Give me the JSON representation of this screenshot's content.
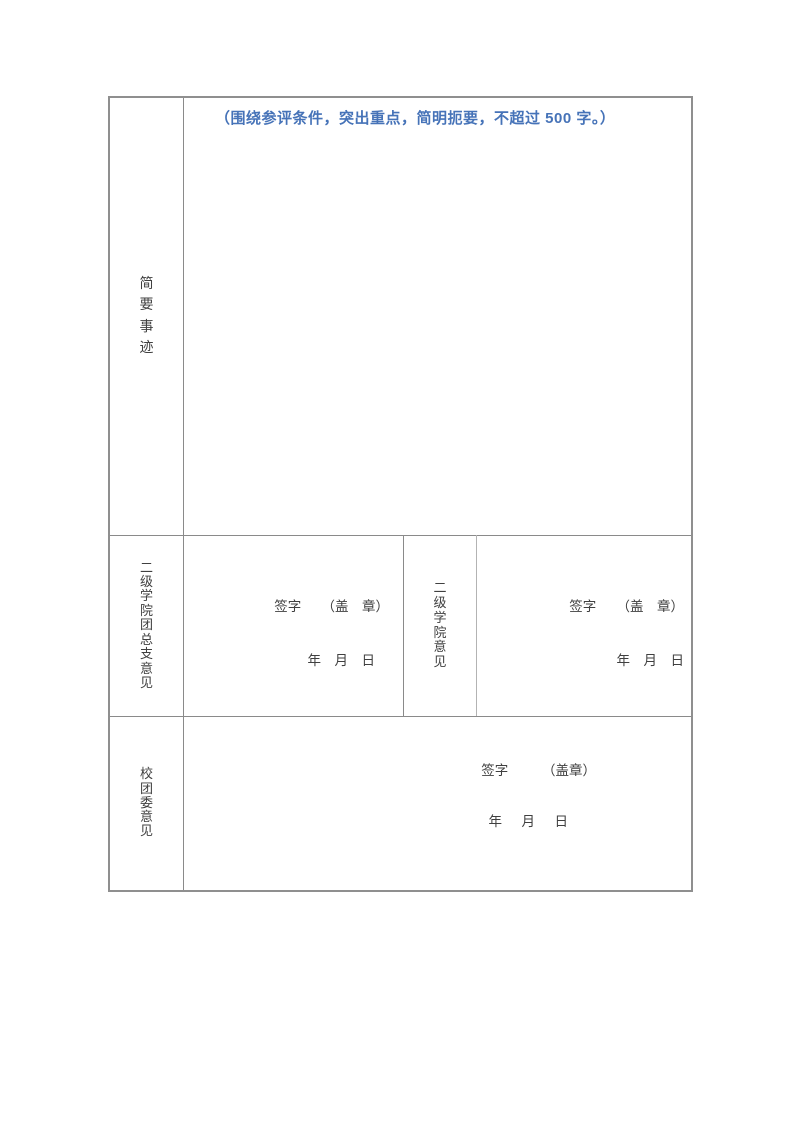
{
  "form": {
    "colors": {
      "instruction_blue": "#4673b8",
      "border_gray": "#8a8a8a",
      "text_gray": "#404040"
    },
    "brief_deeds": {
      "label": "简要事迹",
      "instruction": "（围绕参评条件，突出重点，简明扼要，不超过 500 字。）"
    },
    "league_branch": {
      "label": "二级学院团总支意见",
      "sign_line": "签字　　（盖　章）",
      "date_line": "年　月　日"
    },
    "college": {
      "label": "二级学院意见",
      "sign_line": "签字　　（盖　章）",
      "date_line": "年　月　日"
    },
    "school_committee": {
      "label": "校团委意见",
      "sign_line": "签字　　　（盖章）",
      "date_line": "年　月　日"
    }
  }
}
